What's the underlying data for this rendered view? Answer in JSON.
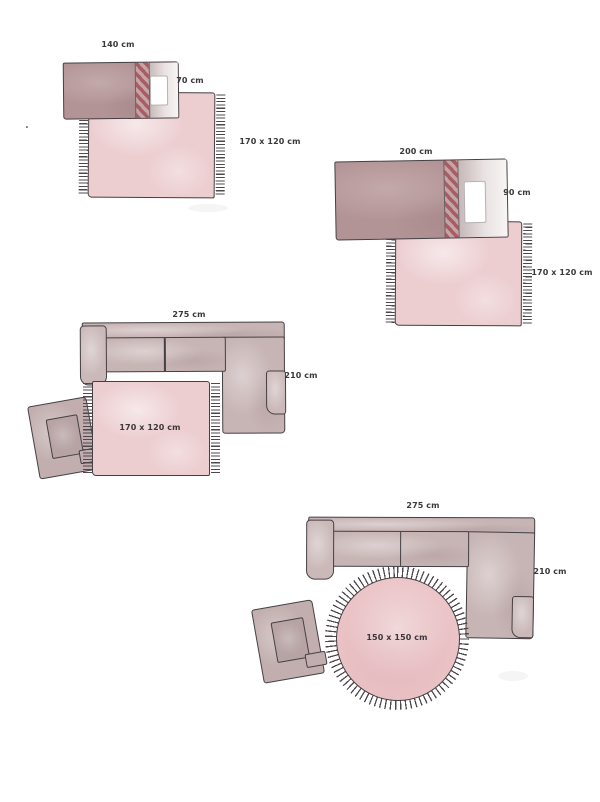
{
  "canvas": {
    "width": 600,
    "height": 802,
    "background": "#ffffff"
  },
  "colors": {
    "outline": "#454044",
    "rug_pink": "#eccdd0",
    "round_rug_pink": "#ebc5c8",
    "furniture_mauve": "#c7b4b4",
    "bed_blanket_mauve": "#b39496",
    "blanket_stripe_red": "#a85d63",
    "fringe_dark": "#4e484c",
    "label_text": "#3b373a"
  },
  "stray_mark": ".",
  "diagrams": [
    {
      "name": "bed-140-with-rug",
      "furniture": "bed",
      "width_label": "140 cm",
      "depth_label": "70 cm",
      "rug_label": "170 x 120 cm",
      "rug_shape": "rectangle"
    },
    {
      "name": "bed-200-with-rug",
      "furniture": "bed",
      "width_label": "200 cm",
      "depth_label": "90 cm",
      "rug_label": "170 x 120 cm",
      "rug_shape": "rectangle"
    },
    {
      "name": "corner-sofa-with-rect-rug",
      "furniture": "corner-sofa",
      "width_label": "275 cm",
      "depth_label": "210 cm",
      "rug_label": "170 x 120 cm",
      "rug_shape": "rectangle"
    },
    {
      "name": "corner-sofa-with-round-rug",
      "furniture": "corner-sofa",
      "width_label": "275 cm",
      "depth_label": "210 cm",
      "rug_label": "150 x 150 cm",
      "rug_shape": "round"
    }
  ]
}
